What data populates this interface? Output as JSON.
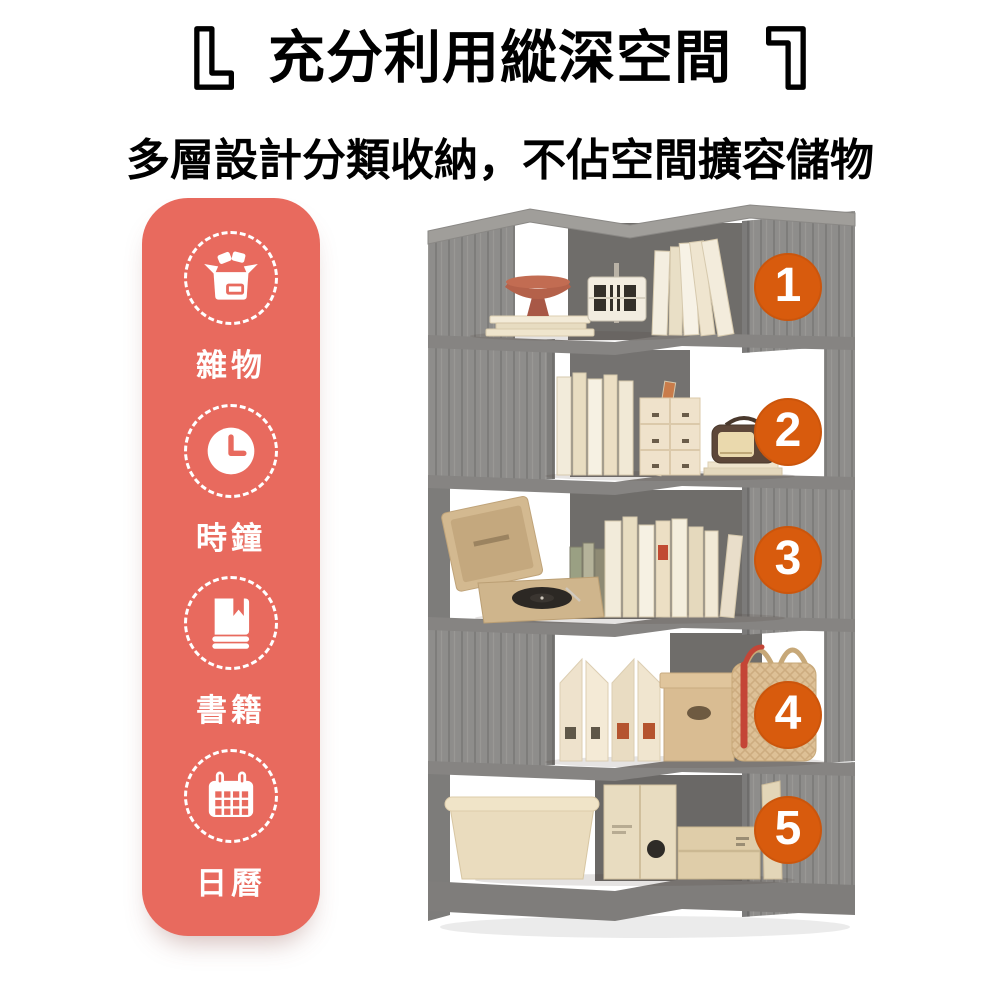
{
  "header": {
    "title": "充分利用縱深空間",
    "subtitle": "多層設計分類收納，不佔空間擴容儲物"
  },
  "category_panel": {
    "background_color": "#e86a5e",
    "items": [
      {
        "icon": "open-box-icon",
        "label": "雜物"
      },
      {
        "icon": "clock-icon",
        "label": "時鐘"
      },
      {
        "icon": "book-icon",
        "label": "書籍"
      },
      {
        "icon": "calendar-icon",
        "label": "日曆"
      }
    ]
  },
  "shelf": {
    "markers": [
      "1",
      "2",
      "3",
      "4",
      "5"
    ],
    "marker_color": "#d85b0d",
    "wood_color": "#8e8d8b"
  }
}
